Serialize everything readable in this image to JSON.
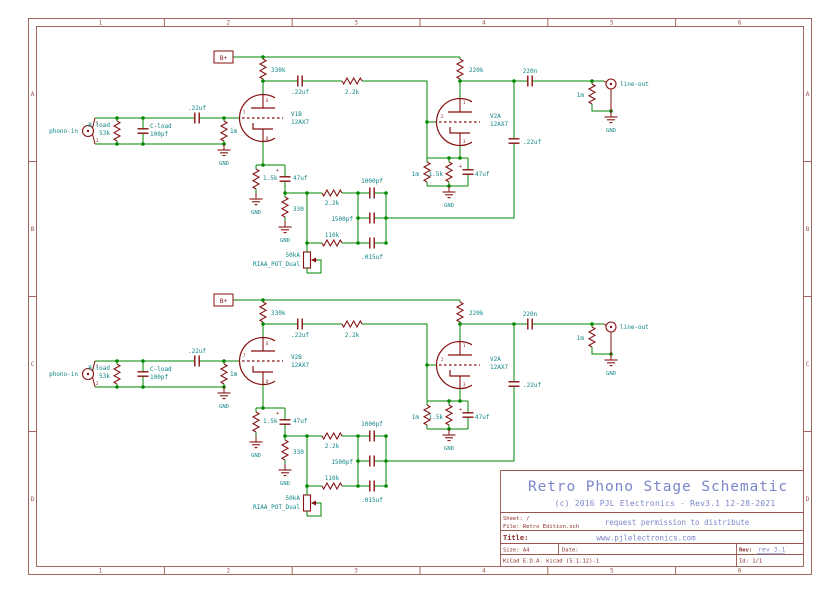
{
  "sheet": {
    "cols": [
      "1",
      "2",
      "3",
      "4",
      "5",
      "6"
    ],
    "rows": [
      "A",
      "B",
      "C",
      "D"
    ],
    "title_block": {
      "title": "Retro Phono Stage Schematic",
      "subtitle": "(c) 2016 PJL Electronics - Rev3.1 12-28-2021",
      "sheet_label": "Sheet: /",
      "file_label": "File: Retro Edition.sch",
      "notice": "request permission to distribute",
      "title_label": "Title:",
      "website": "www.pjlelectronics.com",
      "size_label": "Size: A4",
      "date_label": "Date:",
      "rev_label": "Rev:",
      "rev_value": "rev 3.1",
      "tool_label": "KiCad E.D.A.  kicad (5.1.12)-1",
      "id_label": "Id: 1/1"
    }
  },
  "colors": {
    "wire": "#008700",
    "symbol": "#861212",
    "value": "#108585",
    "blue": "#7b86c8",
    "frame": "#9b564b",
    "frame_text": "#8b2a2a",
    "background": "#ffffff"
  },
  "schematic": {
    "channels": [
      {
        "dy": 0,
        "tube1_ref": "V1B",
        "tube2_ref": "V2A"
      },
      {
        "dy": 243,
        "tube1_ref": "V2B",
        "tube2_ref": "V2A"
      }
    ],
    "wires": [
      [
        233,
        57,
        460,
        57
      ],
      [
        95,
        118,
        185,
        118
      ],
      [
        209,
        118,
        239.5,
        118
      ],
      [
        95,
        144,
        224,
        144
      ],
      [
        263,
        81,
        288,
        81
      ],
      [
        263,
        81,
        263,
        94.5
      ],
      [
        312,
        81,
        338,
        81
      ],
      [
        366,
        81,
        427,
        81,
        427,
        158
      ],
      [
        427,
        122,
        436.5,
        122
      ],
      [
        460,
        81,
        460,
        98.5
      ],
      [
        460,
        81,
        518,
        81
      ],
      [
        542,
        81,
        604,
        81
      ],
      [
        514,
        81,
        514,
        127
      ],
      [
        514,
        155,
        514,
        218,
        386,
        218
      ],
      [
        592,
        107,
        592,
        111,
        611,
        111
      ],
      [
        263,
        141.5,
        263,
        165
      ],
      [
        256,
        165,
        285,
        165
      ],
      [
        285,
        193,
        307,
        193
      ],
      [
        307,
        193,
        318,
        193
      ],
      [
        346,
        193,
        358,
        193
      ],
      [
        307,
        193,
        307,
        250
      ],
      [
        307,
        243,
        318,
        243
      ],
      [
        346,
        243,
        358,
        243
      ],
      [
        358,
        193,
        358,
        243
      ],
      [
        386,
        193,
        386,
        243
      ],
      [
        460,
        145.5,
        460,
        158
      ],
      [
        427,
        158,
        468,
        158
      ],
      [
        427,
        186,
        468,
        186
      ],
      [
        317,
        260,
        321,
        260,
        321,
        273,
        307,
        273
      ],
      [
        307,
        271,
        307,
        273
      ]
    ],
    "junctions": [
      [
        263,
        57
      ],
      [
        117,
        118
      ],
      [
        143,
        118
      ],
      [
        224,
        118
      ],
      [
        117,
        144
      ],
      [
        143,
        144
      ],
      [
        224,
        144
      ],
      [
        263,
        81
      ],
      [
        460,
        81
      ],
      [
        514,
        81
      ],
      [
        592,
        81
      ],
      [
        611,
        111
      ],
      [
        263,
        165
      ],
      [
        285,
        193
      ],
      [
        307,
        193
      ],
      [
        307,
        243
      ],
      [
        358,
        193
      ],
      [
        358,
        218
      ],
      [
        358,
        243
      ],
      [
        386,
        193
      ],
      [
        386,
        218
      ],
      [
        386,
        243
      ],
      [
        427,
        122
      ],
      [
        449,
        158
      ],
      [
        460,
        158
      ],
      [
        449,
        186
      ]
    ],
    "symbols": [
      {
        "t": "jack",
        "x": 88,
        "y": 131,
        "n": "phono-in-jack"
      },
      {
        "t": "res_v",
        "x": 117,
        "y1": 118,
        "y2": 144,
        "n": "resistor-r-load"
      },
      {
        "t": "cap_v",
        "x": 143,
        "y1": 118,
        "y2": 144,
        "n": "capacitor-c-load"
      },
      {
        "t": "cap_h",
        "x1": 185,
        "x2": 209,
        "y": 118,
        "n": "capacitor-input-coupling"
      },
      {
        "t": "res_v",
        "x": 224,
        "y1": 118,
        "y2": 144,
        "n": "resistor-grid-1m"
      },
      {
        "t": "gnd",
        "x": 224,
        "y": 150,
        "n": "gnd-input"
      },
      {
        "t": "flag",
        "x": 214,
        "y": 51,
        "w": 19,
        "h": 12,
        "n": "power-flag-b-plus"
      },
      {
        "t": "res_v",
        "x": 263,
        "y1": 57,
        "y2": 81,
        "n": "resistor-plate-330k"
      },
      {
        "t": "tube",
        "x": 263,
        "y": 118,
        "n": "tube-first-stage"
      },
      {
        "t": "cap_h",
        "x1": 288,
        "x2": 312,
        "y": 81,
        "n": "capacitor-coupling-22uf"
      },
      {
        "t": "res_h",
        "x1": 338,
        "x2": 366,
        "y": 81,
        "n": "resistor-series-2-2k"
      },
      {
        "t": "res_v",
        "x": 460,
        "y1": 57,
        "y2": 81,
        "n": "resistor-plate-220k"
      },
      {
        "t": "tube",
        "x": 460,
        "y": 122,
        "n": "tube-second-stage"
      },
      {
        "t": "res_v",
        "x": 427,
        "y1": 158,
        "y2": 186,
        "n": "resistor-grid2-1m"
      },
      {
        "t": "res_v",
        "x": 449,
        "y1": 158,
        "y2": 186,
        "n": "resistor-cathode2-1-5k"
      },
      {
        "t": "cap_pol_v",
        "x": 468,
        "y1": 158,
        "y2": 186,
        "n": "capacitor-bypass2-47uf"
      },
      {
        "t": "gnd",
        "x": 449,
        "y": 192,
        "n": "gnd-cathode2"
      },
      {
        "t": "cap_h",
        "x1": 518,
        "x2": 542,
        "y": 81,
        "n": "capacitor-output-220n"
      },
      {
        "t": "res_v",
        "x": 592,
        "y1": 81,
        "y2": 107,
        "n": "resistor-load-1m"
      },
      {
        "t": "jack_out",
        "x": 611,
        "y": 84,
        "n": "line-out-jack"
      },
      {
        "t": "gnd",
        "x": 611,
        "y": 117,
        "n": "gnd-output"
      },
      {
        "t": "cap_v",
        "x": 514,
        "y1": 127,
        "y2": 155,
        "n": "capacitor-feedback-22uf"
      },
      {
        "t": "res_v",
        "x": 256,
        "y1": 165,
        "y2": 193,
        "n": "resistor-cathode1-1-5k"
      },
      {
        "t": "gnd",
        "x": 256,
        "y": 199,
        "n": "gnd-cathode1"
      },
      {
        "t": "cap_pol_v",
        "x": 285,
        "y1": 165,
        "y2": 193,
        "n": "capacitor-bypass1-47uf"
      },
      {
        "t": "res_v",
        "x": 285,
        "y1": 193,
        "y2": 221,
        "n": "resistor-330"
      },
      {
        "t": "gnd",
        "x": 285,
        "y": 227,
        "n": "gnd-330"
      },
      {
        "t": "res_h",
        "x1": 318,
        "x2": 346,
        "y": 193,
        "n": "resistor-network-2-2k"
      },
      {
        "t": "res_h",
        "x1": 318,
        "x2": 346,
        "y": 243,
        "n": "resistor-network-110k"
      },
      {
        "t": "cap_h",
        "x1": 358,
        "x2": 386,
        "y": 193,
        "n": "capacitor-1000pf"
      },
      {
        "t": "cap_h",
        "x1": 358,
        "x2": 386,
        "y": 218,
        "n": "capacitor-1500pf"
      },
      {
        "t": "cap_h",
        "x1": 358,
        "x2": 386,
        "y": 243,
        "n": "capacitor-015uf"
      },
      {
        "t": "pot",
        "x": 307,
        "y": 260,
        "n": "riaa-pot"
      }
    ],
    "texts": [
      {
        "x": 78,
        "y": 133,
        "s": "phono-in",
        "a": "end"
      },
      {
        "x": 96,
        "y": 125,
        "s": "1",
        "c": "m",
        "fs": 4
      },
      {
        "x": 96,
        "y": 142,
        "s": "2",
        "c": "m",
        "fs": 4
      },
      {
        "x": 110,
        "y": 127,
        "s": "R-load",
        "a": "end"
      },
      {
        "x": 110,
        "y": 135,
        "s": "53k",
        "a": "end"
      },
      {
        "x": 150,
        "y": 128,
        "s": "C-load"
      },
      {
        "x": 150,
        "y": 136,
        "s": "100pf"
      },
      {
        "x": 197,
        "y": 110,
        "s": ".22uf",
        "a": "middle"
      },
      {
        "x": 230,
        "y": 133,
        "s": "1m"
      },
      {
        "x": 224,
        "y": 165,
        "s": "GND",
        "a": "middle",
        "fs": 5.5
      },
      {
        "x": 223.5,
        "y": 60,
        "s": "B+",
        "c": "m",
        "fs": 6,
        "a": "middle"
      },
      {
        "x": 271,
        "y": 72,
        "s": "330k"
      },
      {
        "x": 291,
        "y": 116,
        "k": "tube1_ref"
      },
      {
        "x": 291,
        "y": 124,
        "s": "12AX7"
      },
      {
        "x": 266,
        "y": 102,
        "s": "6",
        "c": "m",
        "fs": 4
      },
      {
        "x": 243,
        "y": 114,
        "s": "7",
        "c": "m",
        "fs": 4
      },
      {
        "x": 266,
        "y": 140,
        "s": "8",
        "c": "m",
        "fs": 4
      },
      {
        "x": 300,
        "y": 94,
        "s": ".22uf",
        "a": "middle"
      },
      {
        "x": 352,
        "y": 94,
        "s": "2.2k",
        "a": "middle"
      },
      {
        "x": 469,
        "y": 72,
        "s": "220k"
      },
      {
        "x": 530,
        "y": 73,
        "s": "220n",
        "a": "middle"
      },
      {
        "x": 584,
        "y": 97,
        "s": "1m",
        "a": "end"
      },
      {
        "x": 620,
        "y": 86,
        "s": "line-out"
      },
      {
        "x": 611,
        "y": 132,
        "s": "GND",
        "a": "middle",
        "fs": 5.5
      },
      {
        "x": 523,
        "y": 144,
        "s": ".22uf"
      },
      {
        "x": 490,
        "y": 118,
        "k": "tube2_ref"
      },
      {
        "x": 490,
        "y": 126,
        "s": "12AX7"
      },
      {
        "x": 463,
        "y": 104,
        "s": "1",
        "c": "m",
        "fs": 4
      },
      {
        "x": 441,
        "y": 118,
        "s": "2",
        "c": "m",
        "fs": 4
      },
      {
        "x": 463,
        "y": 143,
        "s": "3",
        "c": "m",
        "fs": 4
      },
      {
        "x": 419,
        "y": 176,
        "s": "1m",
        "a": "end"
      },
      {
        "x": 443,
        "y": 176,
        "s": "1.5k",
        "a": "end"
      },
      {
        "x": 475,
        "y": 176,
        "s": "47uf"
      },
      {
        "x": 459,
        "y": 168,
        "s": "+",
        "c": "m",
        "fs": 5
      },
      {
        "x": 449,
        "y": 207,
        "s": "GND",
        "a": "middle",
        "fs": 5.5
      },
      {
        "x": 263,
        "y": 180,
        "s": "1.5k"
      },
      {
        "x": 293,
        "y": 180,
        "s": "47uf"
      },
      {
        "x": 276,
        "y": 172,
        "s": "+",
        "c": "m",
        "fs": 5
      },
      {
        "x": 256,
        "y": 214,
        "s": "GND",
        "a": "middle",
        "fs": 5.5
      },
      {
        "x": 293,
        "y": 211,
        "s": "330"
      },
      {
        "x": 285,
        "y": 242,
        "s": "GND",
        "a": "middle",
        "fs": 5.5
      },
      {
        "x": 332,
        "y": 205,
        "s": "2.2k",
        "a": "middle"
      },
      {
        "x": 332,
        "y": 237,
        "s": "110k",
        "a": "middle"
      },
      {
        "x": 372,
        "y": 183,
        "s": "1000pf",
        "a": "middle"
      },
      {
        "x": 353,
        "y": 221,
        "s": "1500pf",
        "a": "end"
      },
      {
        "x": 372,
        "y": 259,
        "s": ".015uf",
        "a": "middle"
      },
      {
        "x": 300,
        "y": 257,
        "s": "50kA",
        "a": "end"
      },
      {
        "x": 300,
        "y": 266,
        "s": "RIAA_POT_Dual",
        "a": "end"
      }
    ]
  }
}
